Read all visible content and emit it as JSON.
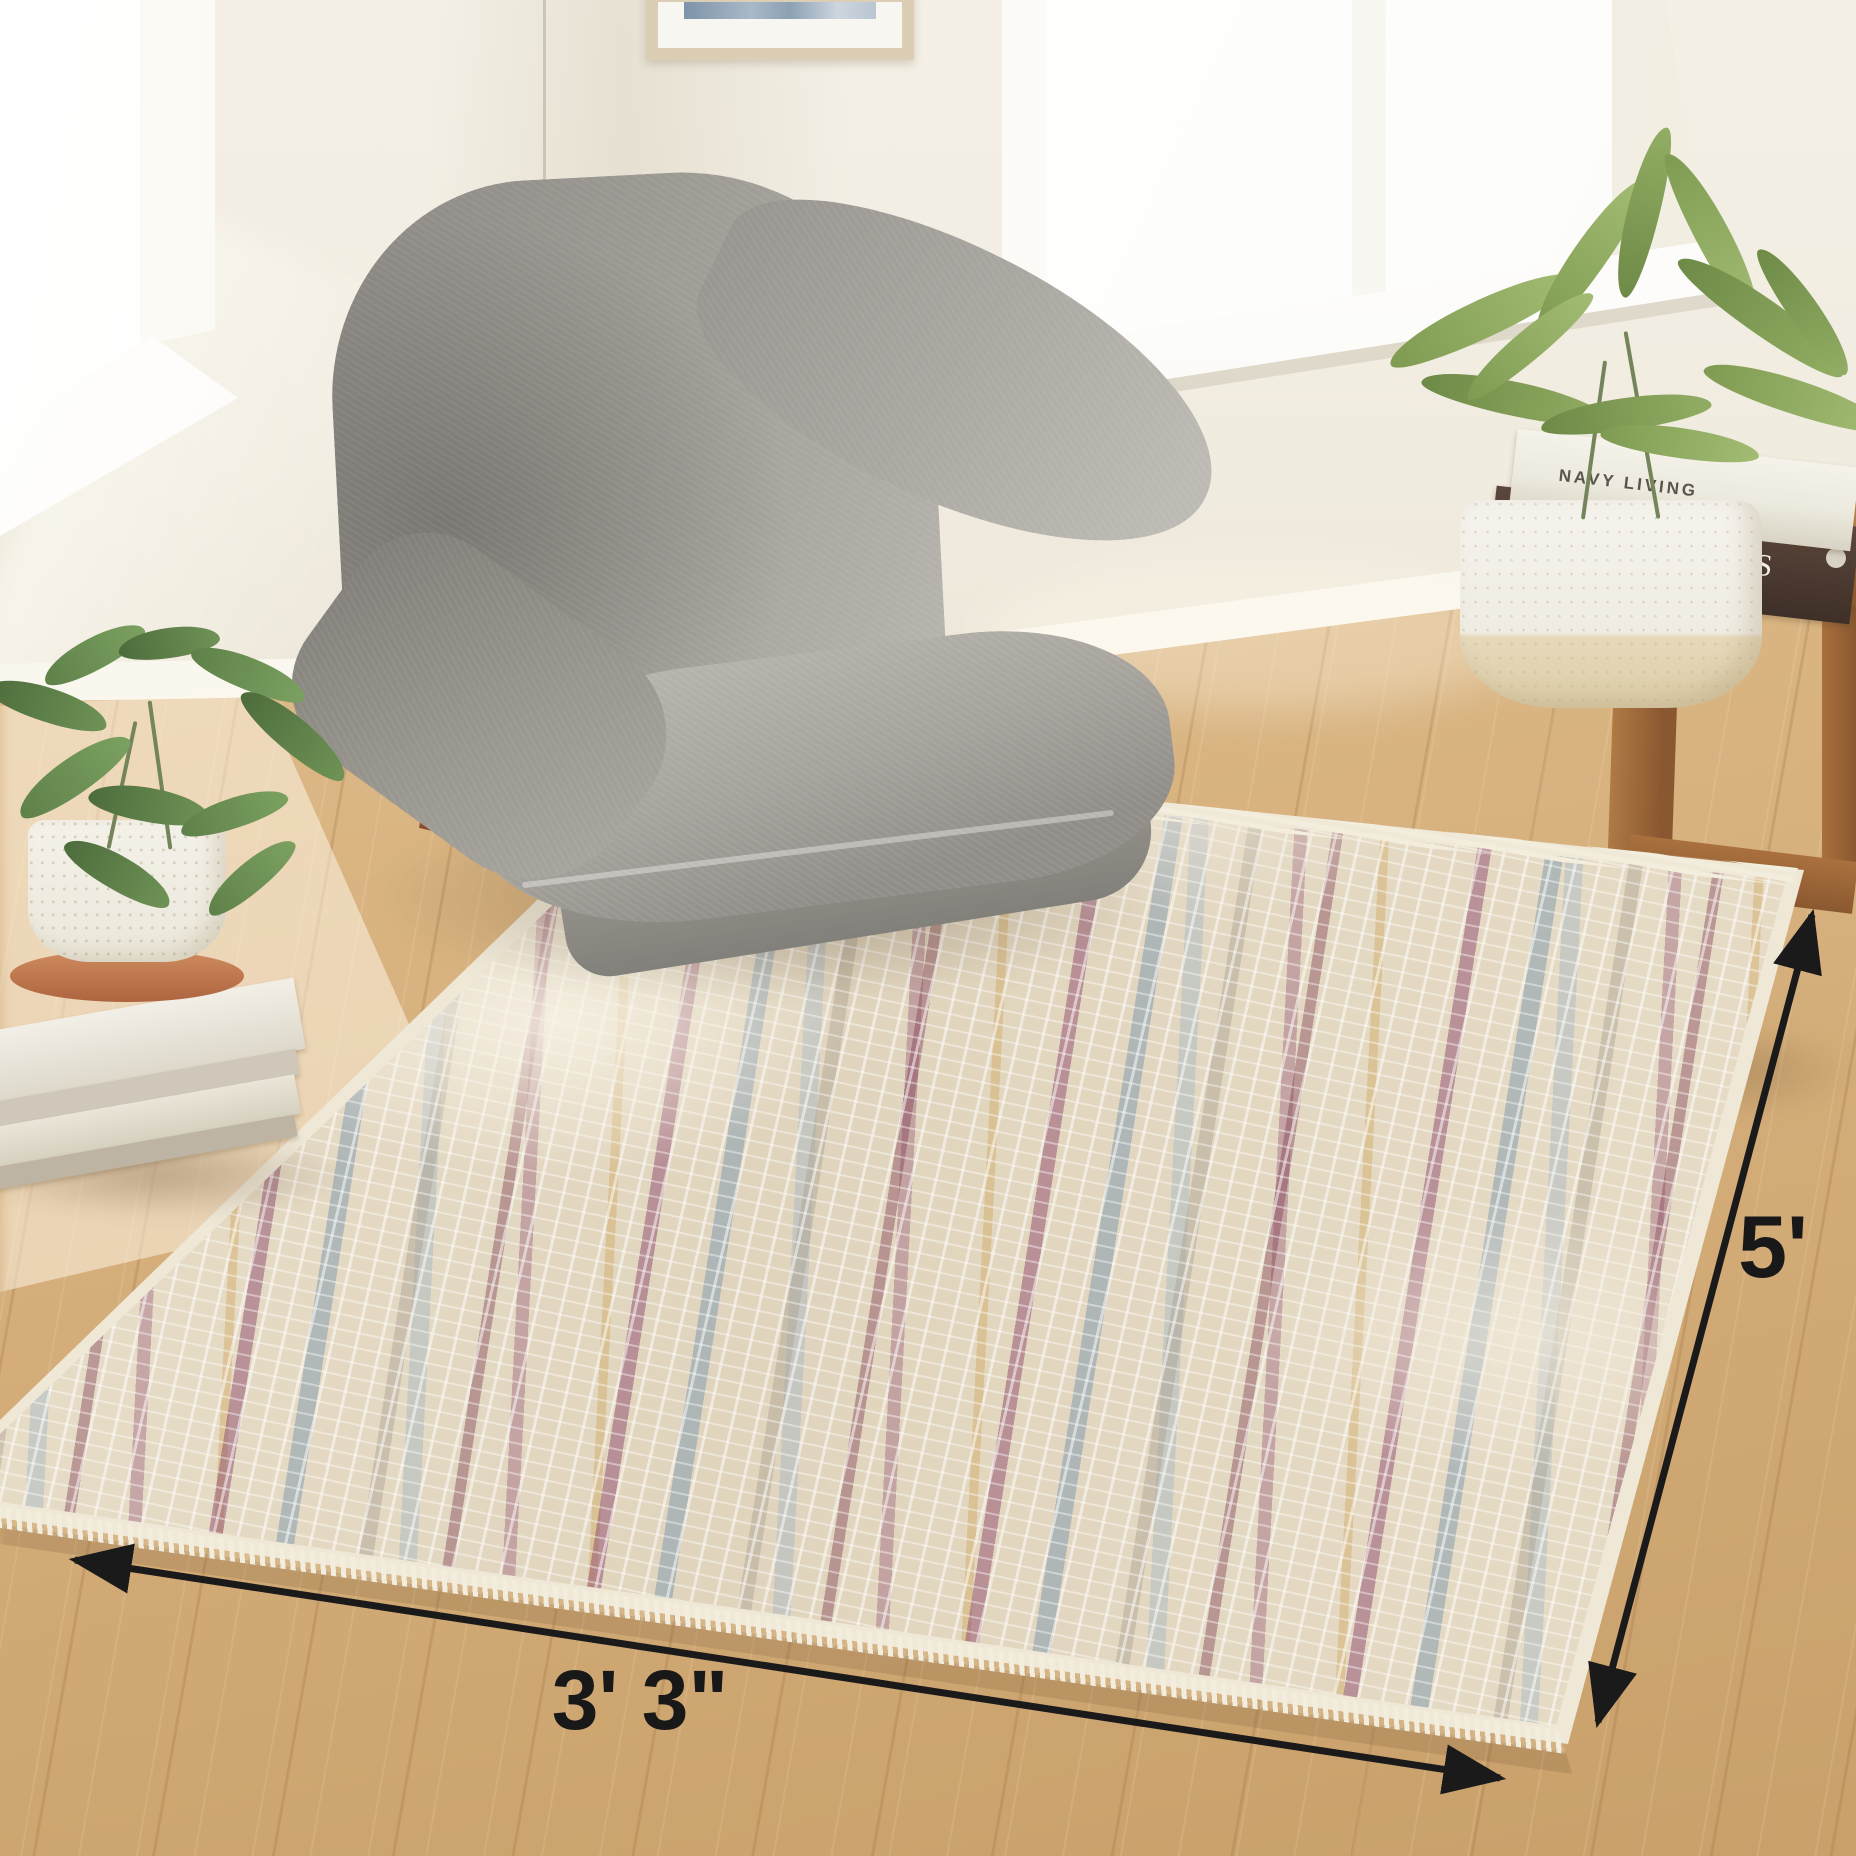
{
  "annotations": {
    "length_label": "5'",
    "width_label": "3' 3\"",
    "line_color": "#1a1a1a"
  },
  "books": {
    "white_book_spine": "NAVY LIVING",
    "dark_book_spine": "ORDUS"
  },
  "scene": {
    "type": "product-photo",
    "subject": "multicolor abstract area rug",
    "objects": [
      "area rug",
      "gray armchair",
      "wood side table",
      "potted plants",
      "book stack",
      "framed artwork",
      "windows",
      "oak floor"
    ]
  },
  "rug_palette": {
    "base": "#e6dcc6",
    "plum": "#8e4a6e",
    "burgundy": "#7e3b52",
    "blue": "#7793ad",
    "slate": "#9fb3c4",
    "gold": "#c9983f",
    "gray": "#aaa191"
  }
}
